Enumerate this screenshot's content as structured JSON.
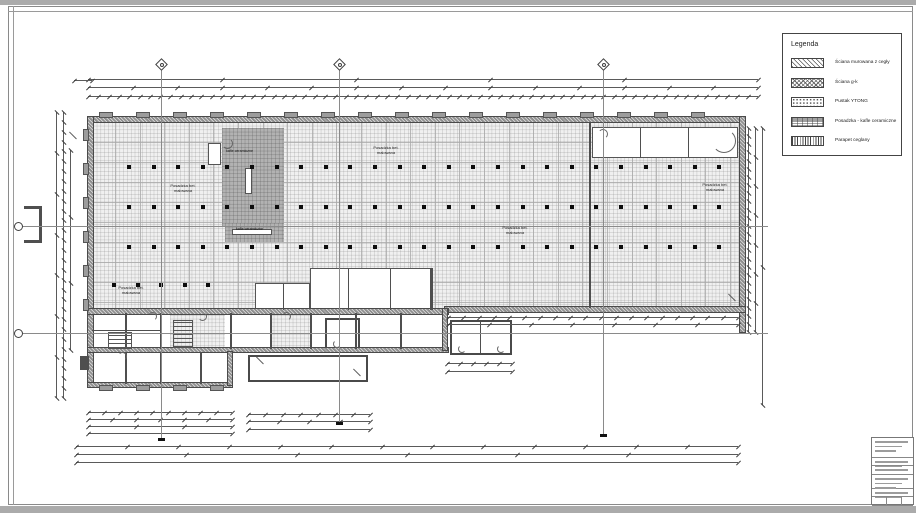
{
  "document": {
    "type": "architectural-floor-plan-sheet",
    "colors": {
      "paper": "#ffffff",
      "page_edge": "#ababab",
      "line": "#4a4a4a",
      "tile_fill": "#f0f0f0",
      "ceramic_room_fill": "#b2b2b2",
      "wall_fill": "#8f8f8f"
    }
  },
  "legend": {
    "x": 782,
    "y": 33,
    "w": 118,
    "h": 121,
    "title": "Legenda",
    "items": [
      {
        "pattern": "pat-diag",
        "label": "Ściana murowana z cegły"
      },
      {
        "pattern": "pat-cross",
        "label": "Ściana g-k"
      },
      {
        "pattern": "pat-stipple",
        "label": "Pustak YTONG"
      },
      {
        "pattern": "pat-floor",
        "label": "Posadzka - kafle ceramiczne"
      },
      {
        "pattern": "pat-vert",
        "label": "Parapet ceglany"
      }
    ]
  },
  "title_block": {
    "x": 871,
    "y": 437,
    "w": 43,
    "h": 68,
    "sections": [
      {
        "h": 20,
        "bars": 3
      },
      {
        "h": 8,
        "bars": 2
      },
      {
        "h": 9,
        "bars": 1
      },
      {
        "h": 14,
        "bars": 3
      },
      {
        "h": 8,
        "bars": 2
      },
      {
        "h": 9,
        "bars": 0,
        "cells": 3
      }
    ]
  },
  "labels": {
    "floor": [
      {
        "x": 163,
        "y": 184,
        "text": "Posadzka bet.\nmalowana"
      },
      {
        "x": 366,
        "y": 146,
        "text": "Posadzka bet.\nmalowana"
      },
      {
        "x": 495,
        "y": 226,
        "text": "Posadzka bet.\nmalowana"
      },
      {
        "x": 695,
        "y": 183,
        "text": "Posadzka bet.\nmalowana"
      },
      {
        "x": 111,
        "y": 286,
        "text": "Posadzka bet.\nmalowana"
      }
    ],
    "tile": [
      {
        "x": 226,
        "y": 149,
        "text": "kafle ceramiczne"
      },
      {
        "x": 236,
        "y": 227,
        "text": "kafle ceramiczne"
      }
    ]
  },
  "plan": {
    "frame": {
      "strips": [
        {
          "x": 0,
          "y": 0,
          "w": 916,
          "h": 5
        },
        {
          "x": 0,
          "y": 506,
          "w": 916,
          "h": 7
        }
      ],
      "border": {
        "x": 8,
        "y": 6,
        "w": 905,
        "h": 499
      },
      "extra_lines": [
        {
          "x": 13,
          "y": 6,
          "w": 1,
          "h": 499
        },
        {
          "x": 8,
          "y": 11,
          "w": 905,
          "h": 1
        }
      ]
    },
    "halls": [
      {
        "x": 93,
        "y": 122,
        "w": 647,
        "h": 186,
        "cls": "tile"
      }
    ],
    "walls": [
      {
        "x": 88,
        "y": 117,
        "w": 652,
        "h": 5
      },
      {
        "x": 88,
        "y": 117,
        "w": 5,
        "h": 270
      },
      {
        "x": 740,
        "y": 117,
        "w": 5,
        "h": 215
      },
      {
        "x": 445,
        "y": 307,
        "w": 300,
        "h": 5
      },
      {
        "x": 88,
        "y": 309,
        "w": 360,
        "h": 5
      },
      {
        "x": 88,
        "y": 348,
        "w": 360,
        "h": 4
      },
      {
        "x": 88,
        "y": 383,
        "w": 144,
        "h": 4
      },
      {
        "x": 228,
        "y": 352,
        "w": 4,
        "h": 33
      },
      {
        "x": 443,
        "y": 309,
        "w": 4,
        "h": 41
      }
    ],
    "partitions": [
      {
        "x": 589,
        "y": 122,
        "w": 2,
        "h": 186
      },
      {
        "x": 430,
        "y": 268,
        "w": 2.5,
        "h": 42
      },
      {
        "x": 125,
        "y": 313,
        "w": 1.5,
        "h": 36
      },
      {
        "x": 160,
        "y": 313,
        "w": 1.5,
        "h": 36
      },
      {
        "x": 230,
        "y": 313,
        "w": 1.5,
        "h": 36
      },
      {
        "x": 270,
        "y": 313,
        "w": 1.5,
        "h": 36
      },
      {
        "x": 310,
        "y": 313,
        "w": 1.5,
        "h": 36
      },
      {
        "x": 355,
        "y": 313,
        "w": 1.5,
        "h": 36
      },
      {
        "x": 400,
        "y": 313,
        "w": 1.5,
        "h": 36
      },
      {
        "x": 125,
        "y": 352,
        "w": 1.5,
        "h": 32
      },
      {
        "x": 160,
        "y": 352,
        "w": 1.5,
        "h": 32
      },
      {
        "x": 200,
        "y": 352,
        "w": 1.5,
        "h": 32
      },
      {
        "x": 92,
        "y": 330,
        "w": 70,
        "h": 1.2
      },
      {
        "x": 640,
        "y": 128,
        "w": 1.2,
        "h": 30
      },
      {
        "x": 688,
        "y": 128,
        "w": 1.2,
        "h": 30
      },
      {
        "x": 348,
        "y": 269,
        "w": 1.2,
        "h": 41
      },
      {
        "x": 390,
        "y": 269,
        "w": 1.2,
        "h": 41
      },
      {
        "x": 283,
        "y": 284,
        "w": 1.2,
        "h": 26
      },
      {
        "x": 24,
        "y": 206,
        "w": 18,
        "h": 2.5
      },
      {
        "x": 39,
        "y": 206,
        "w": 3,
        "h": 37
      },
      {
        "x": 24,
        "y": 240,
        "w": 18,
        "h": 2.5
      },
      {
        "x": 80,
        "y": 356,
        "w": 9,
        "h": 14
      }
    ],
    "rooms": [
      {
        "x": 222,
        "y": 128,
        "w": 62,
        "h": 99,
        "cls": "tile-grey"
      },
      {
        "x": 225,
        "y": 223,
        "w": 59,
        "h": 19,
        "cls": "tile-grey"
      },
      {
        "x": 245,
        "y": 168,
        "w": 7,
        "h": 26,
        "cls": "room-white"
      },
      {
        "x": 232,
        "y": 229,
        "w": 40,
        "h": 6,
        "cls": "room-white"
      },
      {
        "x": 208,
        "y": 143,
        "w": 13,
        "h": 22,
        "cls": "room-white"
      },
      {
        "x": 592,
        "y": 127,
        "w": 146,
        "h": 31,
        "cls": "room-white"
      },
      {
        "x": 310,
        "y": 268,
        "w": 122,
        "h": 44,
        "cls": "room-white"
      },
      {
        "x": 255,
        "y": 283,
        "w": 55,
        "h": 29,
        "cls": "room-white"
      },
      {
        "x": 92,
        "y": 312,
        "w": 353,
        "h": 40,
        "cls": "room-white"
      },
      {
        "x": 170,
        "y": 315,
        "w": 55,
        "h": 35,
        "cls": "tile"
      },
      {
        "x": 270,
        "y": 315,
        "w": 40,
        "h": 35,
        "cls": "tile"
      },
      {
        "x": 92,
        "y": 352,
        "w": 138,
        "h": 33,
        "cls": "room-white"
      },
      {
        "x": 325,
        "y": 318,
        "w": 35,
        "h": 32,
        "cls": "room-thick"
      },
      {
        "x": 248,
        "y": 355,
        "w": 120,
        "h": 27,
        "cls": "room-thick"
      },
      {
        "x": 450,
        "y": 320,
        "w": 62,
        "h": 35,
        "cls": "room-thick"
      },
      {
        "x": 480,
        "y": 322,
        "w": 1.2,
        "h": 31,
        "cls": "part"
      }
    ],
    "stairs": [
      {
        "x": 173,
        "y": 320,
        "w": 20,
        "h": 28
      },
      {
        "x": 108,
        "y": 332,
        "w": 24,
        "h": 17
      }
    ],
    "arcs": [
      {
        "x": 148,
        "y": 312,
        "r": 9,
        "rot": 0
      },
      {
        "x": 198,
        "y": 312,
        "r": 9,
        "rot": 90
      },
      {
        "x": 282,
        "y": 312,
        "r": 9,
        "rot": 0
      },
      {
        "x": 333,
        "y": 340,
        "r": 8,
        "rot": 180
      },
      {
        "x": 458,
        "y": 345,
        "r": 8,
        "rot": 180
      },
      {
        "x": 497,
        "y": 345,
        "r": 8,
        "rot": 180
      },
      {
        "x": 118,
        "y": 352,
        "r": 9,
        "rot": 0
      },
      {
        "x": 222,
        "y": 138,
        "r": 11,
        "rot": 90
      },
      {
        "x": 712,
        "y": 129,
        "r": 24,
        "rot": 90
      },
      {
        "x": 598,
        "y": 129,
        "r": 10,
        "rot": 0
      }
    ],
    "corner_slashes": [
      {
        "x": 255,
        "y": 360,
        "rot": 45
      },
      {
        "x": 352,
        "y": 372,
        "rot": 45
      },
      {
        "x": 68,
        "y": 135,
        "rot": 45
      },
      {
        "x": 727,
        "y": 297,
        "rot": 45
      }
    ],
    "grid_v": {
      "x0": 115,
      "x1": 735,
      "step": 24.6,
      "y": 122,
      "h": 186
    },
    "grid_h": {
      "y0": 142,
      "y1": 302,
      "step": 20,
      "x": 93,
      "w": 647
    },
    "column_rows": [
      {
        "y": 165,
        "x0": 127,
        "x1": 723,
        "step": 24.6
      },
      {
        "y": 205,
        "x0": 127,
        "x1": 723,
        "step": 24.6
      },
      {
        "y": 245,
        "x0": 127,
        "x1": 723,
        "step": 24.6
      },
      {
        "y": 283,
        "x0": 112,
        "x1": 210,
        "step": 23.5
      }
    ],
    "bump_rows": [
      {
        "y": 113,
        "x0": 100,
        "x1": 726,
        "step": 37,
        "w": 12,
        "h": 4
      },
      {
        "y": 386,
        "x0": 100,
        "x1": 215,
        "step": 37,
        "w": 12,
        "h": 4
      }
    ],
    "side_bumps": {
      "x": 84,
      "y0": 130,
      "y1": 300,
      "step": 34,
      "w": 4,
      "h": 10
    },
    "dims_h": [
      {
        "x": 88,
        "y": 79,
        "w": 670,
        "n": 6
      },
      {
        "x": 88,
        "y": 87,
        "w": 670,
        "n": 16
      },
      {
        "x": 88,
        "y": 96,
        "w": 670,
        "n": 66
      },
      {
        "x": 74,
        "y": 80,
        "w": 18,
        "n": 2
      },
      {
        "x": 448,
        "y": 317,
        "w": 290,
        "n": 20
      },
      {
        "x": 448,
        "y": 324,
        "w": 290,
        "n": 8
      },
      {
        "x": 88,
        "y": 412,
        "w": 144,
        "n": 10
      },
      {
        "x": 88,
        "y": 419,
        "w": 144,
        "n": 7
      },
      {
        "x": 88,
        "y": 426,
        "w": 144,
        "n": 4
      },
      {
        "x": 88,
        "y": 433,
        "w": 144,
        "n": 2
      },
      {
        "x": 248,
        "y": 414,
        "w": 122,
        "n": 8
      },
      {
        "x": 248,
        "y": 421,
        "w": 122,
        "n": 5
      },
      {
        "x": 248,
        "y": 429,
        "w": 122,
        "n": 2
      },
      {
        "x": 447,
        "y": 363,
        "w": 65,
        "n": 6
      },
      {
        "x": 447,
        "y": 371,
        "w": 65,
        "n": 2
      },
      {
        "x": 76,
        "y": 446,
        "w": 662,
        "n": 14
      },
      {
        "x": 76,
        "y": 454,
        "w": 662,
        "n": 7
      },
      {
        "x": 76,
        "y": 462,
        "w": 662,
        "n": 2
      }
    ],
    "dims_v": [
      {
        "x": 56,
        "y": 112,
        "h": 286,
        "n": 8
      },
      {
        "x": 63,
        "y": 112,
        "h": 286,
        "n": 30
      },
      {
        "x": 70,
        "y": 150,
        "h": 200,
        "n": 4
      },
      {
        "x": 748,
        "y": 128,
        "h": 204,
        "n": 26
      },
      {
        "x": 755,
        "y": 128,
        "h": 204,
        "n": 8
      },
      {
        "x": 762,
        "y": 128,
        "h": 277,
        "n": 3
      }
    ],
    "axes_top": [
      {
        "x": 161,
        "dy": 64,
        "y0": 70,
        "y1": 438
      },
      {
        "x": 339,
        "dy": 64,
        "y0": 70,
        "y1": 422
      },
      {
        "x": 603,
        "dy": 64,
        "y0": 70,
        "y1": 434
      }
    ],
    "axes_left": [
      {
        "cx": 18,
        "cy": 226,
        "x0": 23,
        "x1": 768
      },
      {
        "cx": 18,
        "cy": 333,
        "x0": 23,
        "x1": 768
      }
    ]
  }
}
